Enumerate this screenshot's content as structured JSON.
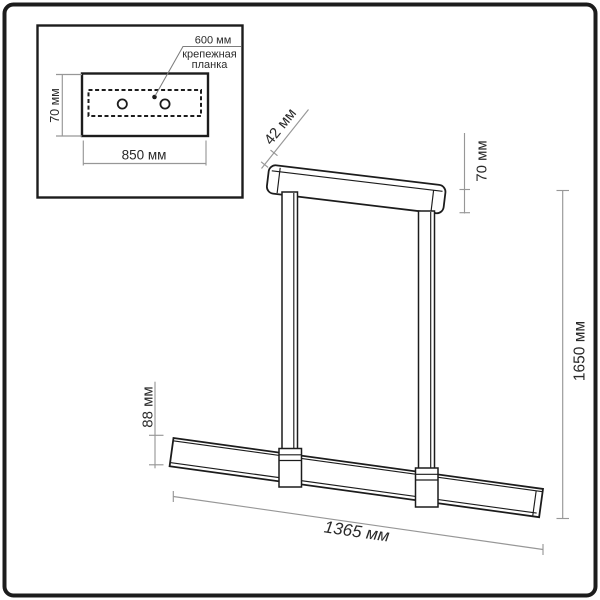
{
  "figure": {
    "type": "technical-dimension-drawing",
    "subject": "linear pendant lamp with ceiling mounting plate",
    "background": "#ffffff",
    "outline_color": "#1c1c1c",
    "dimension_line_color": "#979797",
    "text_color": "#2a2a2a"
  },
  "inset": {
    "bracket_length_label": "600 мм",
    "bracket_name_line1": "крепежная",
    "bracket_name_line2": "планка",
    "plate_height_label": "70 мм",
    "plate_width_label": "850 мм"
  },
  "main": {
    "canopy_depth_label": "42 мм",
    "canopy_height_label": "70 мм",
    "suspension_height_label": "1650 мм",
    "bar_height_label": "88 мм",
    "bar_length_label": "1365 мм"
  }
}
